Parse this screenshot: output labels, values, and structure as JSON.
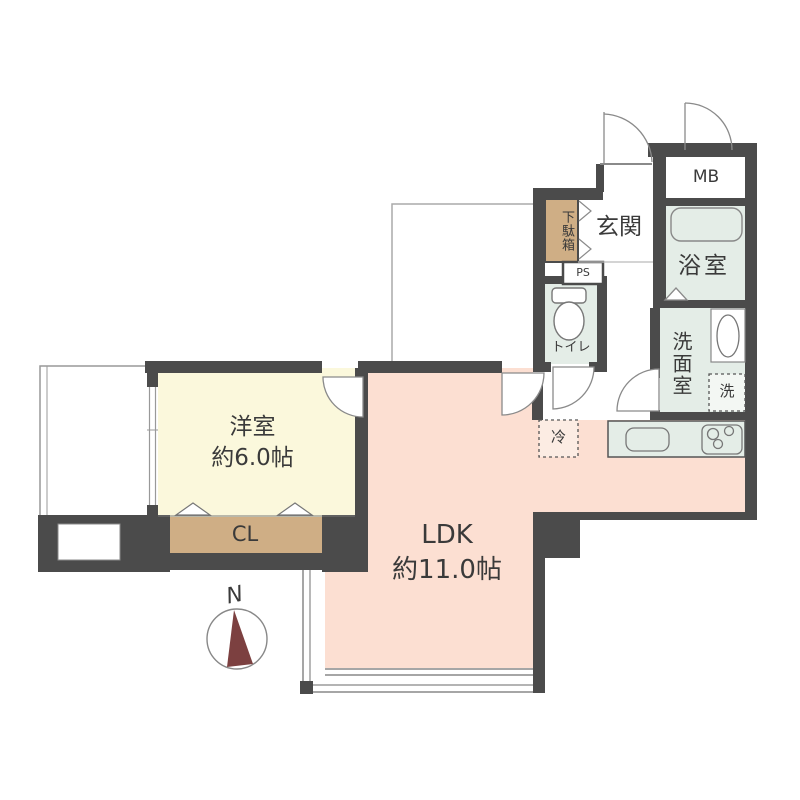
{
  "plan_title": "1LDK floor plan",
  "colors": {
    "wall": "#4b4b4b",
    "western_room_fill": "#fbf8dc",
    "ldk_fill": "#fcdfd2",
    "closet_fill": "#cfae85",
    "wet_area_fill": "#e4ede7",
    "compass_needle": "#7c4040",
    "thin_line": "#888888"
  },
  "rooms": {
    "western": {
      "name": "洋室",
      "size": "約6.0帖"
    },
    "ldk": {
      "name": "LDK",
      "size": "約11.0帖"
    },
    "entrance": {
      "label": "玄関"
    },
    "bathroom": {
      "label": "浴室"
    },
    "washroom": {
      "label": "洗面室"
    },
    "toilet": {
      "label": "トイレ"
    },
    "closet": {
      "label": "CL"
    },
    "shoe_cabinet": {
      "label": "下駄箱"
    },
    "meter_box": {
      "label": "MB"
    },
    "pipe_space": {
      "label": "PS"
    },
    "washer": {
      "label": "洗"
    },
    "refrigerator": {
      "label": "冷"
    }
  },
  "compass": {
    "label": "N"
  }
}
